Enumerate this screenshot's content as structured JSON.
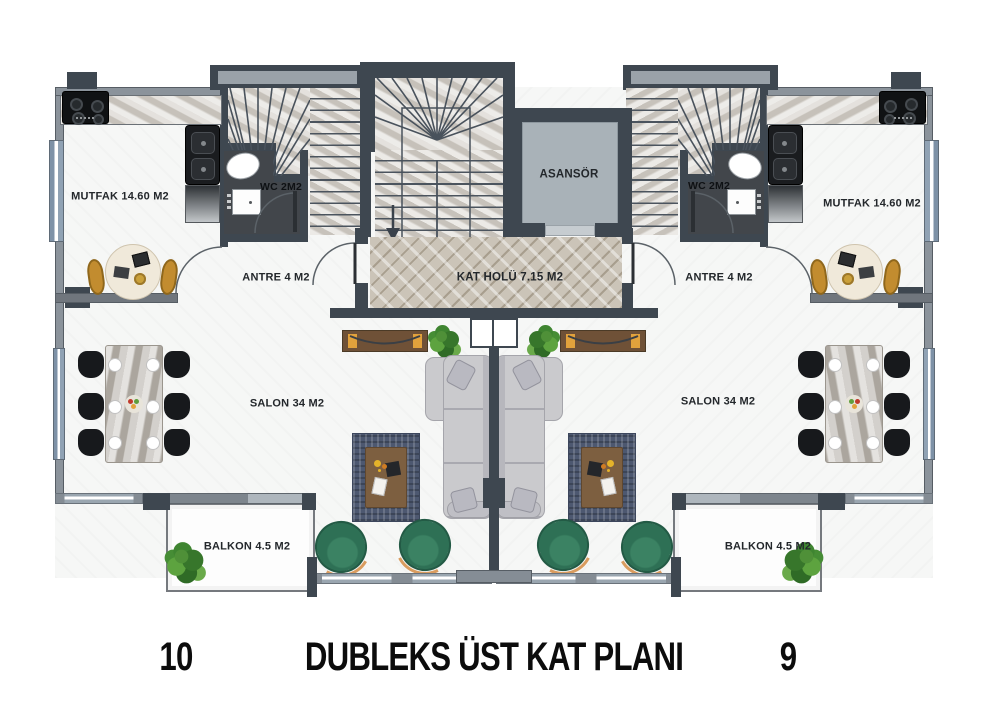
{
  "plan": {
    "title": "DUBLEKS ÜST KAT PLANI",
    "common": {
      "elevator": "ASANSÖR",
      "hall": "KAT HOLÜ 7.15 M2"
    },
    "units": [
      {
        "side": "left",
        "number": "10",
        "rooms": {
          "kitchen": "MUTFAK 14.60 M2",
          "wc": "WC 2M2",
          "entry": "ANTRE 4 M2",
          "living": "SALON 34 M2",
          "balcony": "BALKON 4.5 M2"
        }
      },
      {
        "side": "right",
        "number": "9",
        "rooms": {
          "kitchen": "MUTFAK 14.60 M2",
          "wc": "WC 2M2",
          "entry": "ANTRE 4 M2",
          "living": "SALON 34 M2",
          "balcony": "BALKON 4.5 M2"
        }
      }
    ],
    "colors": {
      "wall_dark": "#3e4750",
      "wall_gray": "#8b939b",
      "window_blue": "#7f93a8",
      "floor_white": "#f6f7f6",
      "stair_marble": "#d8d4ce",
      "hall_tile": "#cbc4b8",
      "elevator_cab": "#a9b2b8",
      "wc_floor": "#42464b",
      "sofa_gray": "#c9c9cd",
      "armchair_green": "#2e7055",
      "rug_navy": "#4d5870",
      "wood_brown": "#7d5f40",
      "accent_gold": "#e2a23c",
      "chair_black": "#17191c",
      "text_dark": "#1a1d20"
    }
  }
}
